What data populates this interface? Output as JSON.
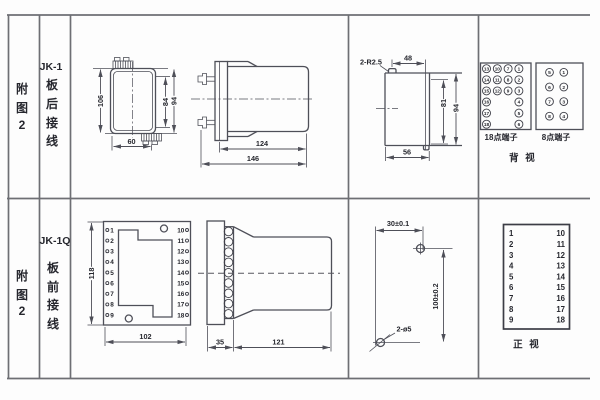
{
  "top_row": {
    "fig": [
      "附",
      "图",
      "2"
    ],
    "model": "JK-1",
    "wiring": [
      "板",
      "后",
      "接",
      "线"
    ],
    "back_view": {
      "h": "106",
      "inner_h": "84",
      "outer_h": "94",
      "w": "60"
    },
    "side_view": {
      "body": "124",
      "total": "146"
    },
    "cutout": {
      "note": "2-R2.5",
      "top": "48",
      "inner_h": "81",
      "outer_h": "94",
      "bottom": "56"
    },
    "t18": {
      "label": "18点端子",
      "col_left": [
        "13",
        "14",
        "15",
        "16",
        "17",
        "18"
      ],
      "col_ml": [
        "10",
        "11",
        "12"
      ],
      "col_mr": [
        "7",
        "8",
        "9"
      ],
      "col_right": [
        "1",
        "2",
        "3",
        "4",
        "5",
        "6"
      ]
    },
    "t8": {
      "label": "8点端子",
      "col_left": [
        "5",
        "6",
        "7",
        "8"
      ],
      "col_right": [
        "1",
        "2",
        "3",
        "4"
      ]
    },
    "view_label": "背 视"
  },
  "bottom_row": {
    "fig": [
      "附",
      "图",
      "2"
    ],
    "model": "JK-1Q",
    "wiring": [
      "板",
      "前",
      "接",
      "线"
    ],
    "front_view": {
      "h": "118",
      "w": "102",
      "left": [
        "1",
        "2",
        "3",
        "4",
        "5",
        "6",
        "7",
        "8",
        "9"
      ],
      "right": [
        "10",
        "11",
        "12",
        "13",
        "14",
        "15",
        "16",
        "17",
        "18"
      ]
    },
    "side_view": {
      "flange": "35",
      "body": "121"
    },
    "drill": {
      "h": "30±0.1",
      "v": "100±0.2",
      "note": "2-ø5"
    },
    "table": {
      "left": [
        "1",
        "2",
        "3",
        "4",
        "5",
        "6",
        "7",
        "8",
        "9"
      ],
      "right": [
        "10",
        "11",
        "12",
        "13",
        "14",
        "15",
        "16",
        "17",
        "18"
      ],
      "view_label": "正 视"
    }
  }
}
